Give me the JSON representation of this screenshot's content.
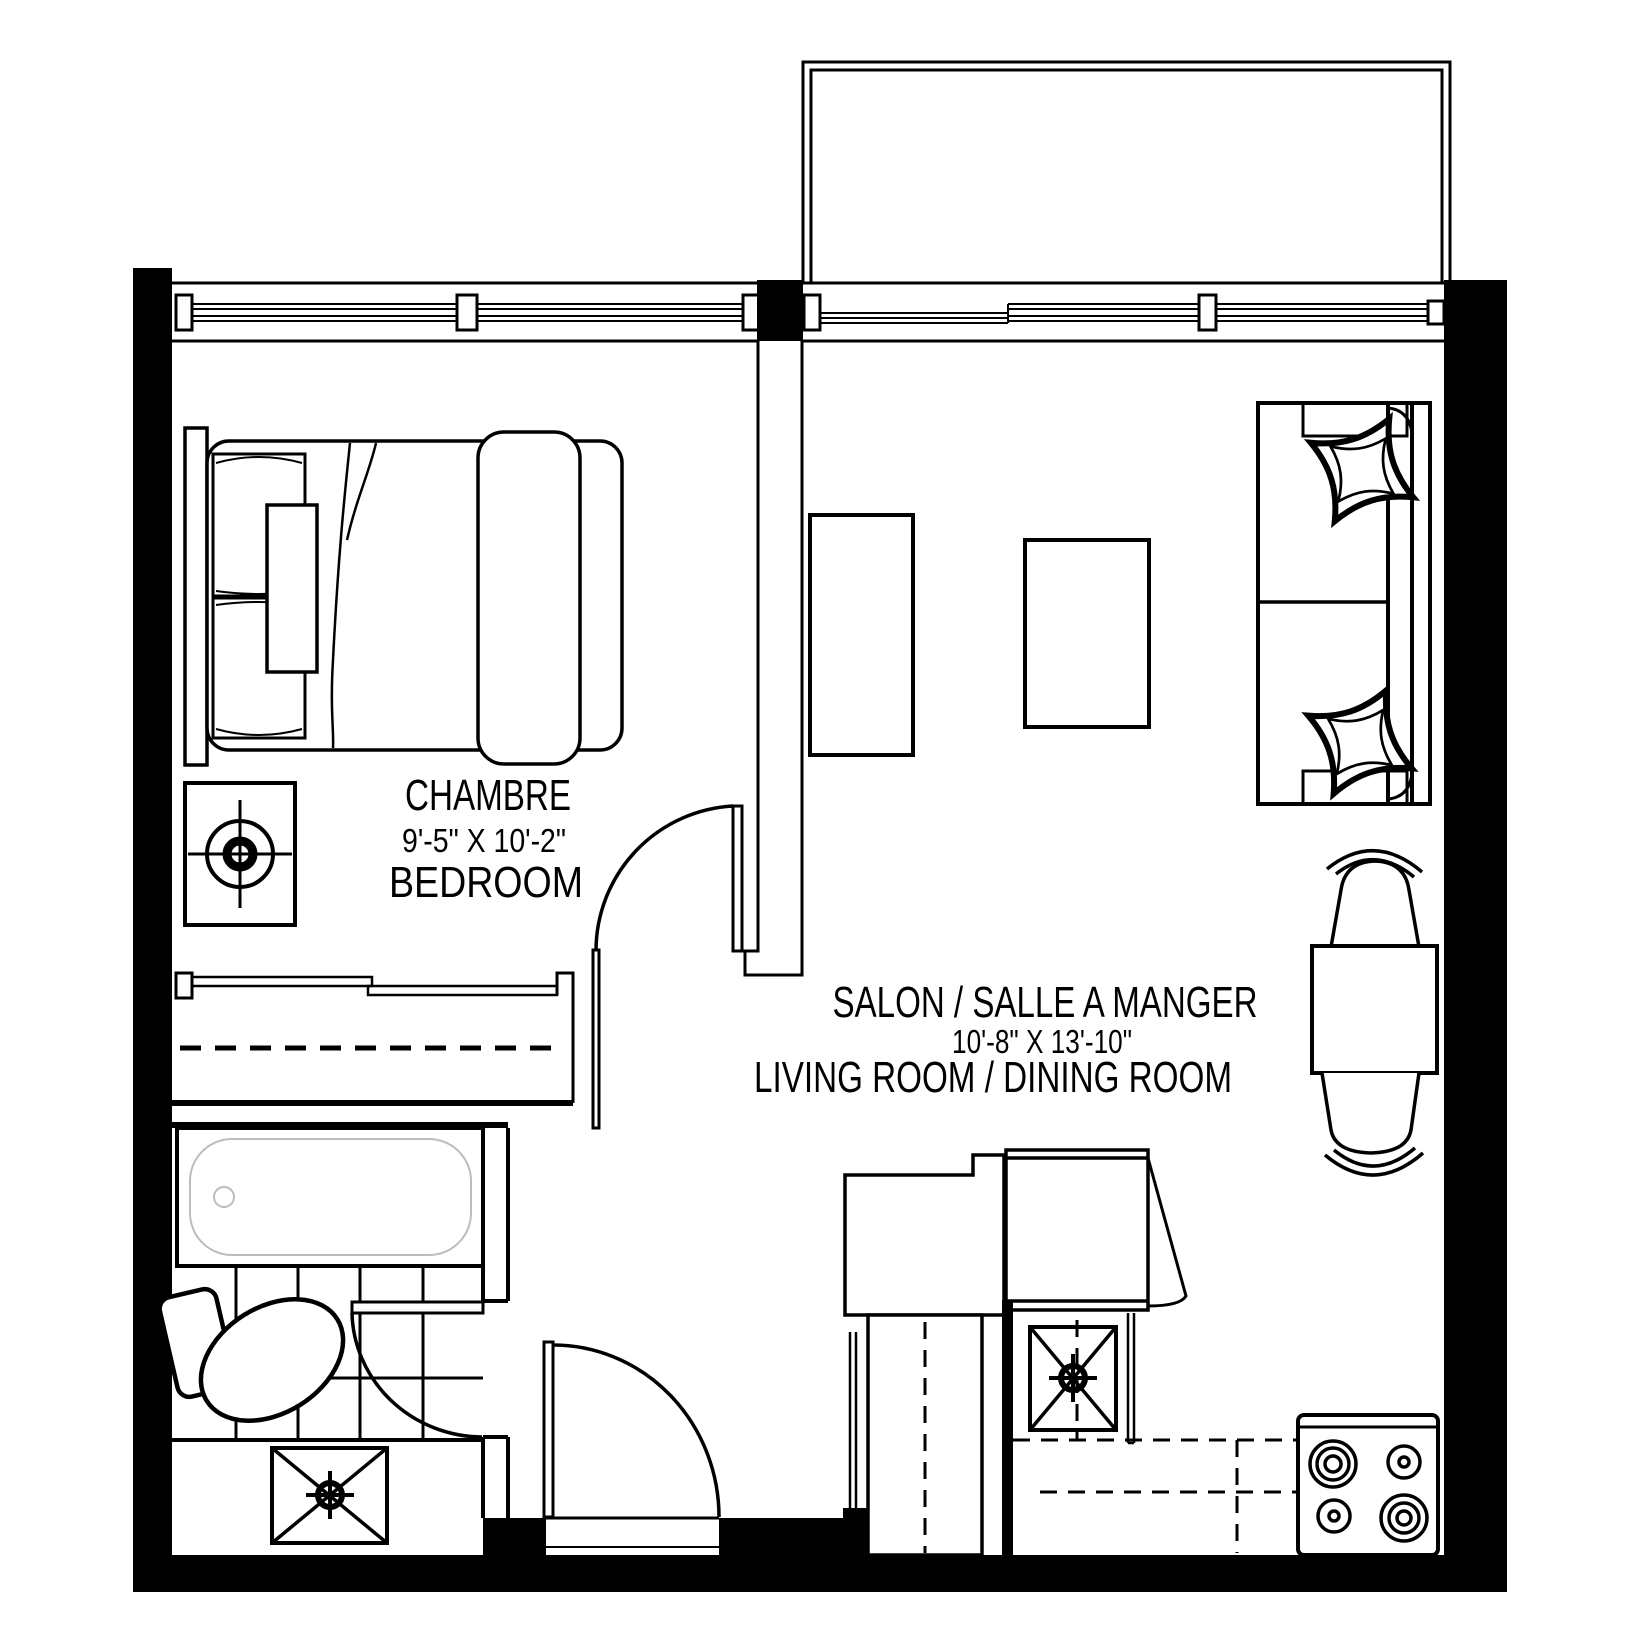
{
  "labels": {
    "bedroom_title": "CHAMBRE",
    "bedroom_dims": "9'-5\" X 10'-2\"",
    "bedroom_subtitle": "BEDROOM",
    "living_title": "SALON / SALLE A MANGER",
    "living_dims": "10'-8\" X 13'-10\"",
    "living_subtitle": "LIVING ROOM  / DINING ROOM"
  },
  "colors": {
    "ink": "#000000",
    "background": "#ffffff",
    "tub_detail": "#bcbcbc"
  }
}
